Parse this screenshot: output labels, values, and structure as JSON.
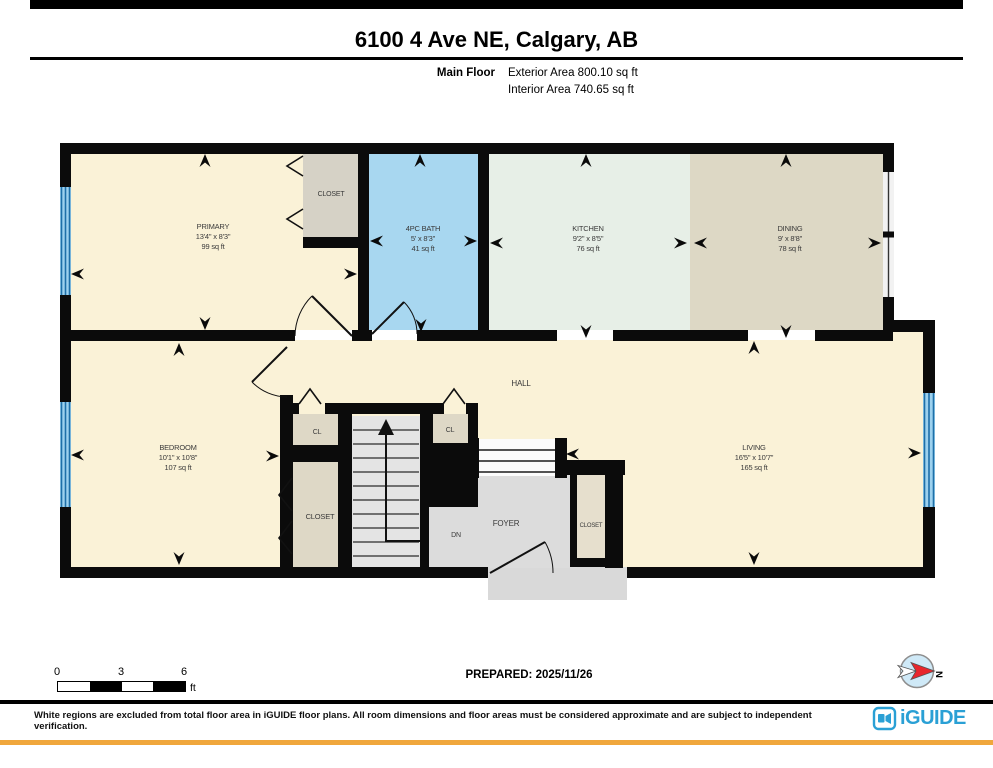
{
  "header": {
    "title": "6100 4 Ave NE, Calgary, AB",
    "floor_label": "Main Floor",
    "exterior_area": "Exterior Area 800.10 sq ft",
    "interior_area": "Interior Area 740.65 sq ft"
  },
  "footer": {
    "scale": {
      "ticks": [
        "0",
        "3",
        "6"
      ],
      "unit": "ft"
    },
    "prepared": "PREPARED: 2025/11/26",
    "compass_n": "N",
    "disclaimer": "White regions are excluded from total floor area in iGUIDE floor plans. All room dimensions and floor areas must be considered approximate and are subject to independent verification.",
    "brand": "iGUIDE"
  },
  "colors": {
    "wall": "#0b0b0b",
    "cream": "#faf2d7",
    "bath": "#a8d7f0",
    "kitchen": "#e7efe7",
    "dining": "#ddd8c5",
    "closet_gray": "#d6d2c6",
    "closet_beige": "#ded8c6",
    "foyer_closet": "#e6dfcd",
    "foyer": "#dcdcdc",
    "stoop": "#d9d9d9",
    "stair": "#e4e4e4",
    "steps_white": "#fbfbfb",
    "window_blue": "#9dd1ee",
    "window_stripe": "#1e6fa8",
    "label": "#3a3a3a",
    "brand_blue": "#2aa0d5",
    "accent_orange": "#f0a73c"
  },
  "plan": {
    "rooms": [
      {
        "name": "primary",
        "label": "PRIMARY",
        "dims": "13'4\" x 8'3\"",
        "area": "99 sq ft",
        "cx": 213,
        "ys": [
          229,
          239,
          249
        ],
        "size": 7.5
      },
      {
        "name": "bath",
        "label": "4PC BATH",
        "dims": "5' x 8'3\"",
        "area": "41 sq ft",
        "cx": 423,
        "ys": [
          231,
          241,
          251
        ],
        "size": 7.5
      },
      {
        "name": "kitchen",
        "label": "KITCHEN",
        "dims": "9'2\" x 8'5\"",
        "area": "76 sq ft",
        "cx": 588,
        "ys": [
          231,
          241,
          251
        ],
        "size": 7.5
      },
      {
        "name": "dining",
        "label": "DINING",
        "dims": "9' x 8'8\"",
        "area": "78 sq ft",
        "cx": 790,
        "ys": [
          231,
          241,
          251
        ],
        "size": 7.5
      },
      {
        "name": "bedroom",
        "label": "BEDROOM",
        "dims": "10'1\" x 10'8\"",
        "area": "107 sq ft",
        "cx": 178,
        "ys": [
          450,
          460,
          470
        ],
        "size": 7.5
      },
      {
        "name": "living",
        "label": "LIVING",
        "dims": "16'5\" x 10'7\"",
        "area": "165 sq ft",
        "cx": 754,
        "ys": [
          450,
          460,
          470
        ],
        "size": 7.5
      }
    ],
    "misc_labels": [
      {
        "t": "CLOSET",
        "x": 331,
        "y": 196,
        "s": 7,
        "name": "primary-closet-label"
      },
      {
        "t": "HALL",
        "x": 521,
        "y": 386,
        "s": 8,
        "name": "hall-label"
      },
      {
        "t": "CL",
        "x": 317,
        "y": 434,
        "s": 7,
        "name": "cl-left-label"
      },
      {
        "t": "CL",
        "x": 450,
        "y": 432,
        "s": 7,
        "name": "cl-right-label"
      },
      {
        "t": "CLOSET",
        "x": 320,
        "y": 519,
        "s": 7.5,
        "name": "bedroom-closet-label"
      },
      {
        "t": "FOYER",
        "x": 506,
        "y": 526,
        "s": 8,
        "name": "foyer-label"
      },
      {
        "t": "DN",
        "x": 456,
        "y": 537,
        "s": 7,
        "name": "stairs-down-label"
      },
      {
        "t": "CLOSET",
        "x": 591,
        "y": 527,
        "s": 6,
        "name": "foyer-closet-label"
      }
    ],
    "fills": [
      {
        "x": 70,
        "y": 340,
        "w": 853,
        "h": 228,
        "c": "cream",
        "name": "hall-living-bedroom-floor"
      },
      {
        "x": 893,
        "y": 332,
        "w": 30,
        "h": 10,
        "c": "cream",
        "name": "living-floor-notch"
      },
      {
        "x": 71,
        "y": 154,
        "w": 287,
        "h": 176,
        "c": "cream",
        "name": "primary-floor"
      },
      {
        "x": 303,
        "y": 154,
        "w": 56,
        "h": 83,
        "c": "closet_gray",
        "name": "primary-closet-floor"
      },
      {
        "x": 369,
        "y": 154,
        "w": 109,
        "h": 176,
        "c": "bath",
        "name": "bath-floor"
      },
      {
        "x": 489,
        "y": 154,
        "w": 201,
        "h": 176,
        "c": "kitchen",
        "name": "kitchen-floor"
      },
      {
        "x": 690,
        "y": 154,
        "w": 193,
        "h": 176,
        "c": "dining",
        "name": "dining-floor"
      },
      {
        "x": 488,
        "y": 567,
        "w": 139,
        "h": 33,
        "c": "stoop",
        "name": "entry-stoop"
      },
      {
        "x": 293,
        "y": 414,
        "w": 45,
        "h": 31,
        "c": "closet_beige",
        "name": "cl-left-floor"
      },
      {
        "x": 433,
        "y": 414,
        "w": 35,
        "h": 29,
        "c": "closet_beige",
        "name": "cl-right-floor"
      },
      {
        "x": 293,
        "y": 462,
        "w": 45,
        "h": 105,
        "c": "closet_beige",
        "name": "bedroom-closet-floor"
      },
      {
        "x": 352,
        "y": 416,
        "w": 68,
        "h": 152,
        "c": "stair",
        "name": "stairwell-floor"
      },
      {
        "x": 443,
        "y": 475,
        "w": 134,
        "h": 93,
        "c": "foyer",
        "name": "foyer-floor"
      },
      {
        "x": 429,
        "y": 507,
        "w": 14,
        "h": 61,
        "c": "foyer",
        "name": "foyer-floor-strip"
      },
      {
        "x": 478,
        "y": 439,
        "w": 77,
        "h": 37,
        "c": "steps_white",
        "name": "foyer-steps-floor"
      },
      {
        "x": 577,
        "y": 475,
        "w": 28,
        "h": 84,
        "c": "foyer_closet",
        "name": "foyer-closet-floor"
      }
    ],
    "stairs": {
      "step_x1": 353,
      "step_x2": 419,
      "step_ys": [
        430,
        444,
        458,
        472,
        486,
        500,
        514,
        528,
        542,
        556
      ],
      "up_arrow_polyline": "427,541 386,541 386,431",
      "up_arrow_head": "M386,419 L378,435 L394,435 Z",
      "dn_steps": [
        [
          479,
          450,
          555,
          450
        ],
        [
          479,
          461,
          555,
          461
        ],
        [
          479,
          472,
          555,
          472
        ]
      ]
    },
    "walls": [
      [
        60,
        143,
        833,
        11
      ],
      [
        60,
        143,
        11,
        435
      ],
      [
        60,
        567,
        428,
        11
      ],
      [
        627,
        567,
        308,
        11
      ],
      [
        883,
        143,
        11,
        189
      ],
      [
        893,
        320,
        42,
        12
      ],
      [
        923,
        320,
        12,
        258
      ],
      [
        358,
        143,
        11,
        197
      ],
      [
        478,
        143,
        11,
        197
      ],
      [
        303,
        237,
        56,
        11
      ],
      [
        60,
        330,
        235,
        11
      ],
      [
        352,
        330,
        20,
        11
      ],
      [
        417,
        330,
        140,
        11
      ],
      [
        613,
        330,
        135,
        11
      ],
      [
        815,
        330,
        78,
        11
      ],
      [
        280,
        395,
        13,
        173
      ],
      [
        293,
        403,
        6,
        11
      ],
      [
        325,
        403,
        119,
        11
      ],
      [
        466,
        403,
        12,
        11
      ],
      [
        280,
        445,
        72,
        17
      ],
      [
        338,
        405,
        14,
        163
      ],
      [
        420,
        405,
        13,
        102
      ],
      [
        420,
        443,
        58,
        64
      ],
      [
        420,
        505,
        9,
        63
      ],
      [
        468,
        405,
        10,
        40
      ],
      [
        555,
        438,
        12,
        40
      ],
      [
        475,
        438,
        4,
        40
      ],
      [
        567,
        460,
        58,
        15
      ],
      [
        570,
        472,
        7,
        91
      ],
      [
        605,
        461,
        18,
        107
      ],
      [
        570,
        558,
        53,
        9
      ]
    ],
    "windows": [
      {
        "x": 60,
        "y": 187,
        "w": 11,
        "h": 108,
        "style": "blue",
        "name": "primary-window"
      },
      {
        "x": 60,
        "y": 402,
        "w": 11,
        "h": 105,
        "style": "blue",
        "name": "bedroom-window"
      },
      {
        "x": 883,
        "y": 172,
        "w": 11,
        "h": 125,
        "style": "line",
        "name": "dining-window"
      },
      {
        "x": 923,
        "y": 393,
        "w": 12,
        "h": 114,
        "style": "blue",
        "name": "living-window"
      }
    ],
    "doors": [
      {
        "leaf": "M352,336 L312,296",
        "arc": "M295,336 A57 57 0 0 1 312,296",
        "name": "primary-door"
      },
      {
        "leaf": "M372,334 L404,302",
        "arc": "M417,334 A45 45 0 0 0 404,302",
        "name": "bath-door"
      },
      {
        "leaf": "M287,347 L252,382",
        "arc": "M252,382 A50 50 0 0 0 287,397",
        "name": "bedroom-door"
      },
      {
        "leaf": "M490,573 L545,542",
        "arc": "M553,573 A63 63 0 0 0 545,542",
        "name": "entry-door"
      }
    ],
    "bifolds": [
      {
        "pts": "303,156 287,166 303,176",
        "name": "primary-closet-bifold-1"
      },
      {
        "pts": "303,209 287,219 303,229",
        "name": "primary-closet-bifold-2"
      },
      {
        "pts": "299,404 310,389 321,404",
        "name": "cl-left-bifold"
      },
      {
        "pts": "443,404 454,389 465,404",
        "name": "cl-right-bifold"
      },
      {
        "pts": "292,478 279,495 292,511",
        "name": "bedroom-closet-bifold-1"
      },
      {
        "pts": "292,521 279,538 292,554",
        "name": "bedroom-closet-bifold-2"
      }
    ],
    "arrows": [
      {
        "x": 205,
        "y": 154,
        "d": "up"
      },
      {
        "x": 205,
        "y": 330,
        "d": "down"
      },
      {
        "x": 71,
        "y": 274,
        "d": "left"
      },
      {
        "x": 357,
        "y": 274,
        "d": "right"
      },
      {
        "x": 420,
        "y": 154,
        "d": "up"
      },
      {
        "x": 421,
        "y": 332,
        "d": "down"
      },
      {
        "x": 370,
        "y": 241,
        "d": "left"
      },
      {
        "x": 477,
        "y": 241,
        "d": "right"
      },
      {
        "x": 586,
        "y": 154,
        "d": "up"
      },
      {
        "x": 586,
        "y": 338,
        "d": "down"
      },
      {
        "x": 490,
        "y": 243,
        "d": "left"
      },
      {
        "x": 687,
        "y": 243,
        "d": "right"
      },
      {
        "x": 694,
        "y": 243,
        "d": "left"
      },
      {
        "x": 786,
        "y": 154,
        "d": "up"
      },
      {
        "x": 786,
        "y": 338,
        "d": "down"
      },
      {
        "x": 881,
        "y": 243,
        "d": "right"
      },
      {
        "x": 179,
        "y": 343,
        "d": "up"
      },
      {
        "x": 179,
        "y": 565,
        "d": "down"
      },
      {
        "x": 71,
        "y": 455,
        "d": "left"
      },
      {
        "x": 279,
        "y": 456,
        "d": "right"
      },
      {
        "x": 754,
        "y": 341,
        "d": "up"
      },
      {
        "x": 754,
        "y": 565,
        "d": "down"
      },
      {
        "x": 921,
        "y": 453,
        "d": "right"
      },
      {
        "x": 566,
        "y": 454,
        "d": "left"
      }
    ]
  }
}
